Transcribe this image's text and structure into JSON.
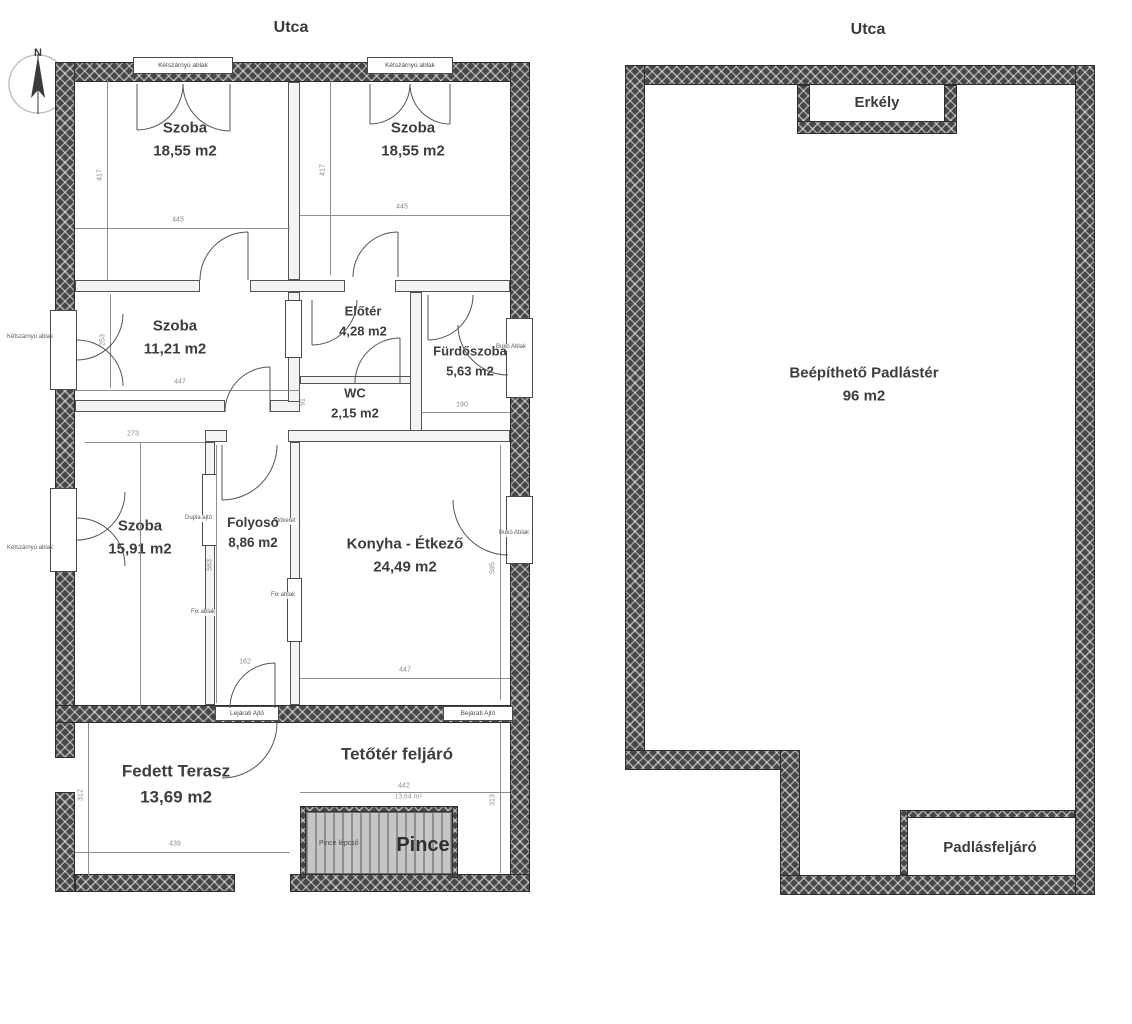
{
  "colors": {
    "wall_dark": "#474747",
    "wall_light": "#f4f4f4",
    "line": "#555555",
    "dim_text": "#8a8a8a",
    "label_text": "#3d3d3d",
    "stair_fill": "#c6c6c6"
  },
  "ground_floor": {
    "street_label": "Utca",
    "compass_label": "N",
    "rooms": {
      "szoba1": {
        "name": "Szoba",
        "area": "18,55 m2"
      },
      "szoba2": {
        "name": "Szoba",
        "area": "18,55 m2"
      },
      "szoba3": {
        "name": "Szoba",
        "area": "11,21 m2"
      },
      "eloter": {
        "name": "Előtér",
        "area": "4,28 m2"
      },
      "wc": {
        "name": "WC",
        "area": "2,15 m2"
      },
      "furdoszoba": {
        "name": "Fürdőszoba",
        "area": "5,63 m2"
      },
      "szoba4": {
        "name": "Szoba",
        "area": "15,91 m2"
      },
      "folyoso": {
        "name": "Folyosó",
        "area": "8,86 m2"
      },
      "konyha": {
        "name": "Konyha - Étkező",
        "area": "24,49 m2"
      },
      "terasz": {
        "name": "Fedett Terasz",
        "area": "13,69 m2"
      },
      "tetoter": {
        "name": "Tetőtér feljáró",
        "area": "13,64 m²"
      },
      "pince": {
        "name": "Pince"
      }
    },
    "dims": {
      "r1_h": "417",
      "r1_w": "445",
      "r2_h": "417",
      "r2_w": "445",
      "sz3_h": "253",
      "sz3_w": "447",
      "wc_h": "91",
      "furdo_w": "190",
      "sz4_w": "273",
      "folyoso_h": "583",
      "folyoso_door": "162",
      "konyha_w": "447",
      "konyha_h": "595",
      "terasz_h": "312",
      "terasz_w": "439",
      "tetoter_w": "442",
      "tetoter_h": "313"
    },
    "annotations": {
      "ketszarnyu": "Kétszárnyú ablak",
      "buko": "Bukó Ablak",
      "fix": "Fix ablak",
      "dupla": "Dupla ajtó",
      "ajtokeret": "Ajtókeret",
      "lejarati": "Lejárati Ajtó",
      "bejarati": "Bejárati Ajtó",
      "pince_lepcso": "Pince lépcső"
    }
  },
  "attic": {
    "street_label": "Utca",
    "rooms": {
      "erkely": {
        "name": "Erkély"
      },
      "padlaster": {
        "name": "Beépíthető Padlástér",
        "area": "96 m2"
      },
      "padlasfeljaro": {
        "name": "Padlásfeljáró"
      }
    }
  }
}
